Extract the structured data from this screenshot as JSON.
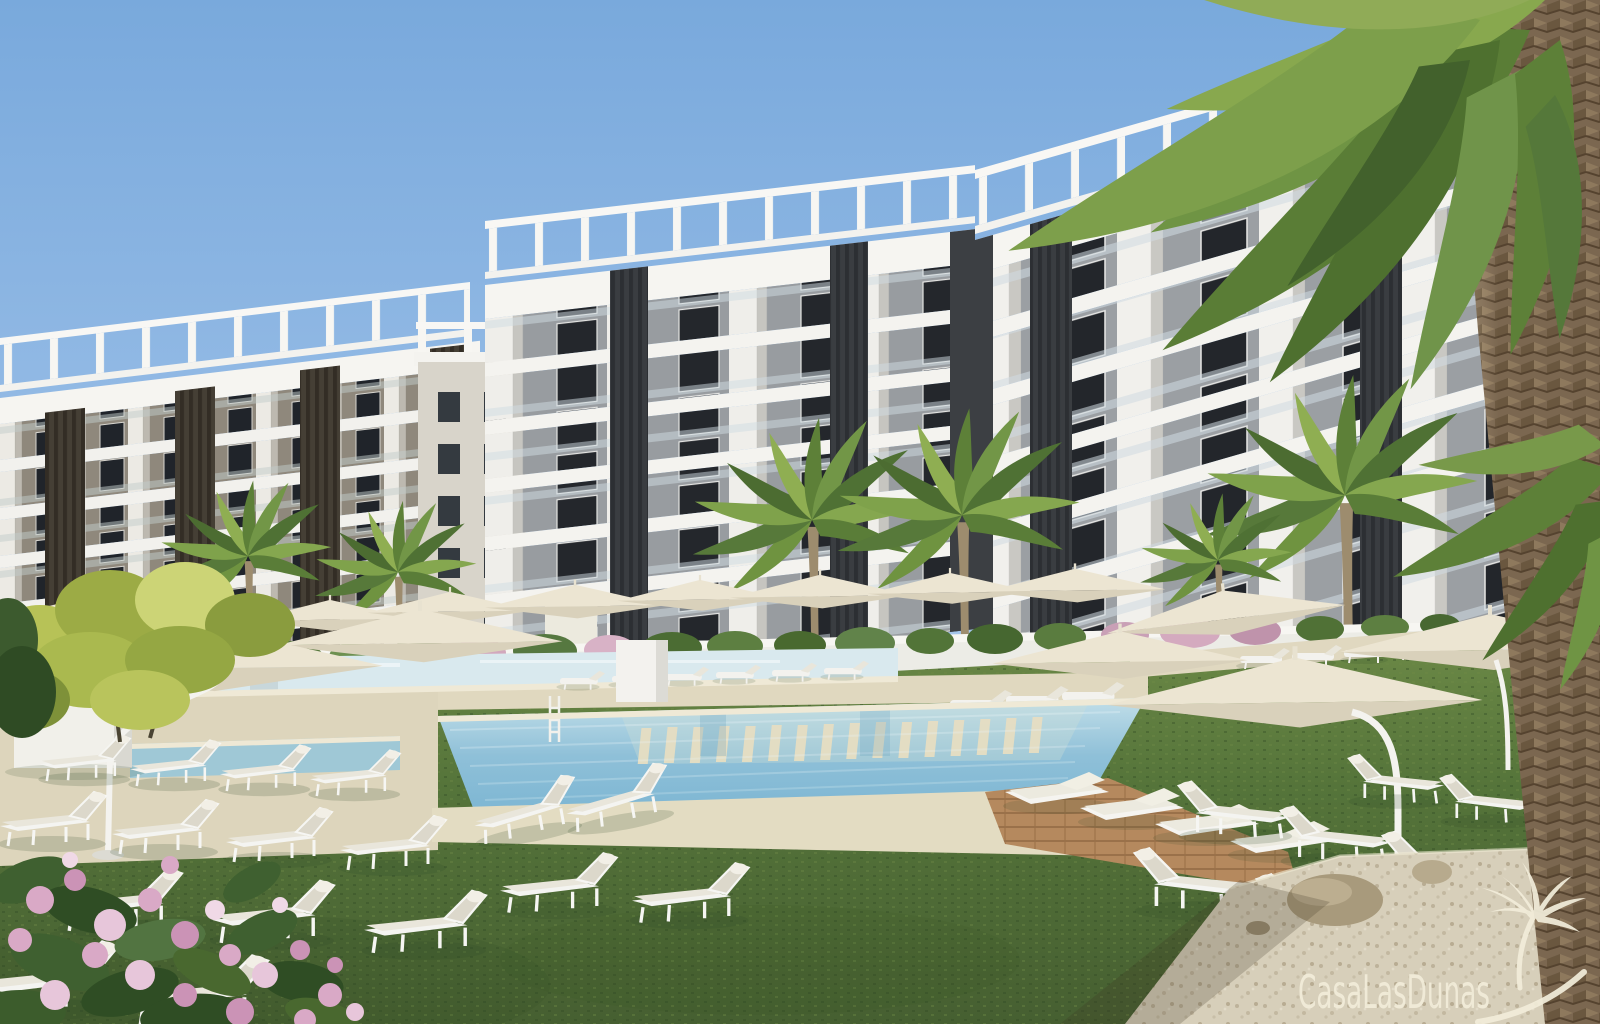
{
  "watermark": {
    "brand_text": "CasaLasDunas",
    "logo_icon": "palm-tree-swoosh-icon"
  },
  "scene": {
    "kind": "architectural exterior render",
    "elements": [
      "blue sky",
      "two white apartment buildings with balconies and dark louver columns",
      "rooftop pergola railings",
      "palm trees",
      "large palm trunk right edge",
      "lap pool and main swimming pool with in-pool sun shelf",
      "spa pool",
      "beige stone deck",
      "wooden deck with daybeds",
      "green lawn",
      "white sun loungers with cushions",
      "cream cantilever parasols",
      "white planter wall with shrubs and pink bougainvillea",
      "yellow-green tree",
      "pink oleander flowers",
      "gravel path with rocks",
      "white pool cabinet"
    ]
  },
  "palette": {
    "sky_top": "#79a9dc",
    "sky_horizon": "#cfe2f2",
    "building_white": "#f6f5f1",
    "facade_wall": "#9b9fa3",
    "facade_dark": "#3a3d41",
    "left_facade_brown": "#8f887c",
    "grass_mid": "#55743a",
    "grass_dark": "#3f5a2d",
    "pool_light": "#c2dfe9",
    "pool_deep": "#7db6d3",
    "deck_beige": "#ded6bd",
    "wood_deck": "#b5895e",
    "umbrella_cream": "#ece5d2",
    "flower_pink": "#d9a9c6",
    "palm_green": "#6f9344",
    "palm_trunk": "#7b6750",
    "gravel": "#d7cfba",
    "watermark_cream": "#f2edda"
  }
}
